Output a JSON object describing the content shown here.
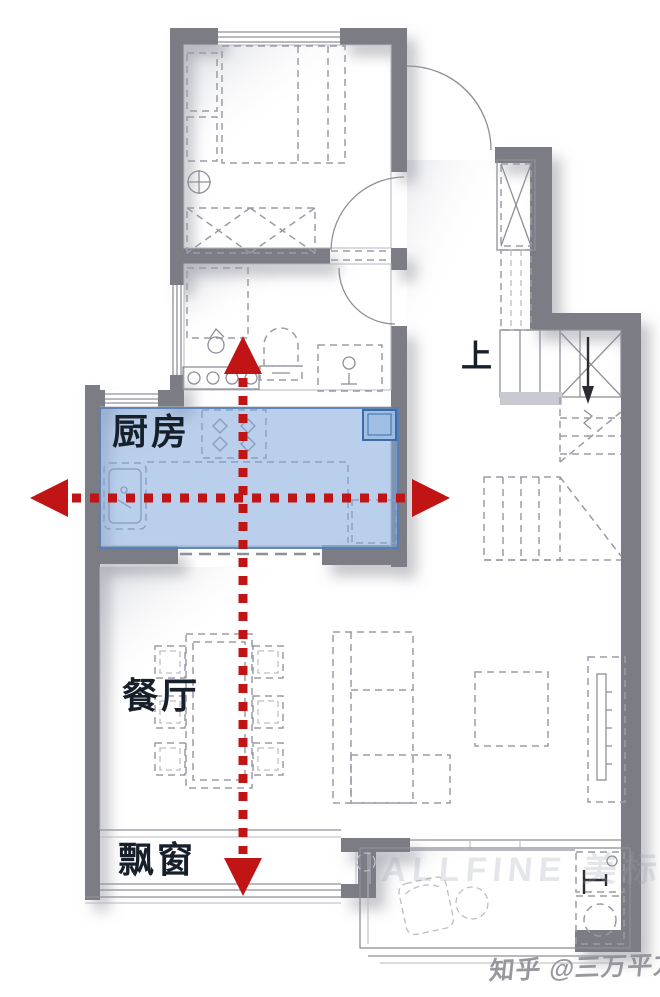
{
  "labels": {
    "kitchen": "厨房",
    "dining": "餐厅",
    "bay_window": "飘窗",
    "stairs_up": "上"
  },
  "watermarks": {
    "site": "知乎 @三万平方",
    "brand": "ALLFINE 美标"
  },
  "colors": {
    "wall": "#7c7c85",
    "kitchen_highlight_fill": "#7fa8da",
    "kitchen_highlight_border": "#557db4",
    "arrow_red": "#c11414",
    "plan_line": "#9b9ba6"
  }
}
